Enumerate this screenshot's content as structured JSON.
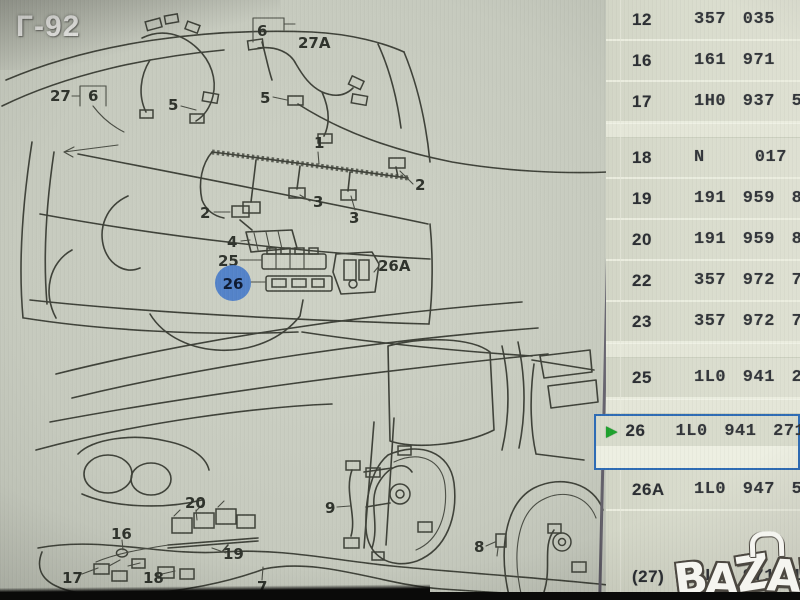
{
  "photo": {
    "page_code": "Г-92",
    "watermark": "BAZAR"
  },
  "colors": {
    "diagram_bg": "#c6cabe",
    "table_bg": "#d8dbcc",
    "line": "#3f4239",
    "selection_border": "#2e6cb5",
    "selection_marker_green": "#1ea22d",
    "highlight_circle_blue": "#4d7ec9",
    "watermark_fill": "#f5f5f0"
  },
  "diagram": {
    "description": "Exploded wiring-harness line drawing: car rear with tailgate harness (top) and dashboard / door harnesses (bottom)",
    "labels": {
      "l27": "27",
      "l6_left": "6",
      "l5_left": "5",
      "l6_right": "6",
      "l27a": "27A",
      "l5_right": "5",
      "l1": "1",
      "l2_left": "2",
      "l2_right": "2",
      "l3_upper": "3",
      "l3_lower": "3",
      "l4": "4",
      "l25": "25",
      "l26": "26",
      "l26a": "26A",
      "l20": "20",
      "l19": "19",
      "l16": "16",
      "l17": "17",
      "l18": "18",
      "l7": "7",
      "l9": "9",
      "l8": "8"
    },
    "highlighted_item": "26"
  },
  "table": {
    "selection_marker": "▶",
    "rows": [
      {
        "pos": "12",
        "part": "357 035"
      },
      {
        "pos": "16",
        "part": "161 971"
      },
      {
        "pos": "17",
        "part": "1H0 937 5"
      },
      {
        "pos": "18",
        "part": "N   017 1",
        "group_break_before": true
      },
      {
        "pos": "19",
        "part": "191 959 8"
      },
      {
        "pos": "20",
        "part": "191 959 86"
      },
      {
        "pos": "22",
        "part": "357 972 75"
      },
      {
        "pos": "23",
        "part": "357 972 753"
      },
      {
        "pos": "25",
        "part": "1L0 941 269",
        "group_break_before": true
      },
      {
        "pos": "26",
        "part": "1L0 941 271",
        "selected": true,
        "group_break_before": true
      },
      {
        "pos": "26A",
        "part": "1L0 947 555"
      },
      {
        "pos": "(27)",
        "part": "1L0 971 145",
        "large_gap_before": true
      }
    ]
  }
}
